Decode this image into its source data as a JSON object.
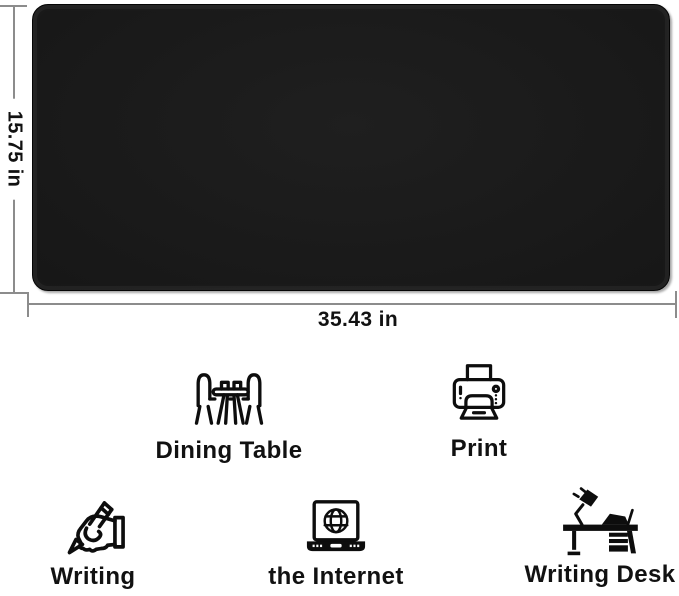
{
  "dimensions": {
    "height_label": "15.75 in",
    "width_label": "35.43 in"
  },
  "product": {
    "surface_color": "#171717",
    "edge_highlight_color": "#c4c4c4"
  },
  "features": [
    {
      "label": "Dining Table",
      "icon": "dining-table-icon"
    },
    {
      "label": "Print",
      "icon": "printer-icon"
    },
    {
      "label": "Writing",
      "icon": "writing-hand-icon"
    },
    {
      "label": "the Internet",
      "icon": "laptop-internet-icon"
    },
    {
      "label": "Writing Desk",
      "icon": "writing-desk-icon"
    }
  ],
  "colors": {
    "background": "#ffffff",
    "dimension_line": "#8c8c8c",
    "label_text": "#111111",
    "icon_stroke": "#0d0d0d"
  }
}
